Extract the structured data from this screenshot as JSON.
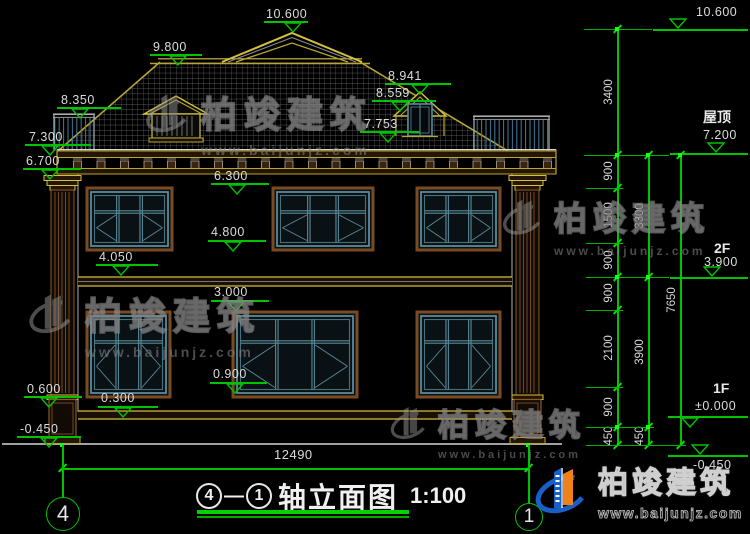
{
  "watermark": {
    "brand": "柏竣建筑",
    "url": "www.baijunjz.com"
  },
  "watermarks": [
    {
      "x": 143,
      "y": 86,
      "scale": 1.0
    },
    {
      "x": 26,
      "y": 286,
      "scale": 1.02
    },
    {
      "x": 500,
      "y": 192,
      "scale": 0.92
    },
    {
      "x": 388,
      "y": 400,
      "scale": 0.85
    }
  ],
  "elevation_markers": [
    {
      "text": "10.600",
      "tx": 266,
      "ty": 8,
      "lx": 264,
      "lw": 44,
      "ly": 21,
      "ax": 293,
      "side": "below"
    },
    {
      "text": "9.800",
      "tx": 153,
      "ty": 41,
      "lx": 150,
      "lw": 52,
      "ly": 54,
      "ax": 178,
      "side": "below"
    },
    {
      "text": "8.350",
      "tx": 61,
      "ty": 94,
      "lx": 57,
      "lw": 64,
      "ly": 107,
      "ax": 80,
      "side": "below"
    },
    {
      "text": "7.300",
      "tx": 29,
      "ty": 131,
      "lx": 25,
      "lw": 66,
      "ly": 144,
      "ax": 50,
      "side": "below"
    },
    {
      "text": "6.700",
      "tx": 26,
      "ty": 155,
      "lx": 23,
      "lw": 58,
      "ly": 168,
      "ax": 50,
      "side": "below"
    },
    {
      "text": "8.941",
      "tx": 388,
      "ty": 70,
      "lx": 385,
      "lw": 66,
      "ly": 83,
      "ax": 420,
      "side": "below"
    },
    {
      "text": "8.559",
      "tx": 376,
      "ty": 87,
      "lx": 372,
      "lw": 64,
      "ly": 100,
      "ax": 400,
      "side": "below"
    },
    {
      "text": "7.753",
      "tx": 364,
      "ty": 118,
      "lx": 360,
      "lw": 60,
      "ly": 131,
      "ax": 388,
      "side": "below"
    },
    {
      "text": "6.300",
      "tx": 214,
      "ty": 170,
      "lx": 211,
      "lw": 58,
      "ly": 183,
      "ax": 237,
      "side": "below"
    },
    {
      "text": "4.800",
      "tx": 211,
      "ty": 226,
      "lx": 208,
      "lw": 58,
      "ly": 240,
      "ax": 233,
      "side": "below"
    },
    {
      "text": "4.050",
      "tx": 99,
      "ty": 251,
      "lx": 96,
      "lw": 62,
      "ly": 264,
      "ax": 121,
      "side": "below"
    },
    {
      "text": "3.000",
      "tx": 214,
      "ty": 286,
      "lx": 211,
      "lw": 58,
      "ly": 300,
      "ax": 236,
      "side": "below"
    },
    {
      "text": "0.900",
      "tx": 213,
      "ty": 368,
      "lx": 210,
      "lw": 57,
      "ly": 382,
      "ax": 235,
      "side": "below"
    },
    {
      "text": "0.300",
      "tx": 101,
      "ty": 392,
      "lx": 98,
      "lw": 60,
      "ly": 406,
      "ax": 123,
      "side": "below"
    },
    {
      "text": "0.600",
      "tx": 27,
      "ty": 383,
      "lx": 24,
      "lw": 58,
      "ly": 396,
      "ax": 49,
      "side": "below"
    },
    {
      "text": "-0.450",
      "tx": 20,
      "ty": 423,
      "lx": 17,
      "lw": 64,
      "ly": 436,
      "ax": 49,
      "side": "below"
    },
    {
      "text": "10.600",
      "tx": 696,
      "ty": 6,
      "lx": 653,
      "lw": 95,
      "ly": 29,
      "ax": 678,
      "side": "above"
    },
    {
      "text": "7.200",
      "name": "屋顶",
      "nx": 703,
      "ny": 110,
      "tx": 703,
      "ty": 129,
      "lx": 670,
      "lw": 78,
      "ly": 153,
      "ax": 716,
      "side": "above"
    },
    {
      "text": "3.900",
      "name": "2F",
      "nx": 714,
      "ny": 241,
      "tx": 704,
      "ty": 256,
      "lx": 670,
      "lw": 78,
      "ly": 277,
      "ax": 712,
      "side": "above"
    },
    {
      "text": "±0.000",
      "name": "1F",
      "nx": 713,
      "ny": 381,
      "tx": 695,
      "ty": 400,
      "lx": 668,
      "lw": 80,
      "ly": 416,
      "ax": 690,
      "side": "below"
    },
    {
      "text": "-0.450",
      "tx": 693,
      "ty": 459,
      "lx": 668,
      "lw": 80,
      "ly": 455,
      "ax": 700,
      "side": "above"
    }
  ],
  "dim_chains": [
    {
      "x": 617,
      "y1": 29,
      "y2": 445,
      "ticks": [
        29,
        155,
        188,
        243,
        277,
        310,
        387,
        427,
        445
      ],
      "labels": [
        {
          "t": "3400",
          "y": 92
        },
        {
          "t": "900",
          "y": 171
        },
        {
          "t": "1500",
          "y": 215
        },
        {
          "t": "900",
          "y": 260
        },
        {
          "t": "900",
          "y": 293
        },
        {
          "t": "2100",
          "y": 348
        },
        {
          "t": "900",
          "y": 407
        },
        {
          "t": "450",
          "y": 436
        }
      ]
    },
    {
      "x": 648,
      "y1": 155,
      "y2": 445,
      "ticks": [
        155,
        277,
        427,
        445
      ],
      "labels": [
        {
          "t": "3300",
          "y": 216
        },
        {
          "t": "3900",
          "y": 352
        },
        {
          "t": "450",
          "y": 436
        }
      ]
    },
    {
      "x": 680,
      "y1": 155,
      "y2": 445,
      "ticks": [
        155,
        445
      ],
      "labels": [
        {
          "t": "7650",
          "y": 300
        }
      ]
    }
  ],
  "ext_lines": [
    {
      "y": 29,
      "x1": 584,
      "x2": 652
    },
    {
      "y": 155,
      "x1": 584,
      "x2": 669
    },
    {
      "y": 188,
      "x1": 586,
      "x2": 623
    },
    {
      "y": 243,
      "x1": 586,
      "x2": 623
    },
    {
      "y": 277,
      "x1": 586,
      "x2": 669
    },
    {
      "y": 310,
      "x1": 586,
      "x2": 623
    },
    {
      "y": 387,
      "x1": 586,
      "x2": 623
    },
    {
      "y": 427,
      "x1": 586,
      "x2": 654
    },
    {
      "y": 445,
      "x1": 586,
      "x2": 686
    }
  ],
  "grips": [
    [
      617,
      29
    ],
    [
      617,
      155
    ],
    [
      648,
      155
    ],
    [
      680,
      155
    ],
    [
      617,
      277
    ],
    [
      648,
      277
    ],
    [
      617,
      427
    ],
    [
      648,
      427
    ],
    [
      62,
      445
    ],
    [
      528,
      445
    ]
  ],
  "bottom_dim": {
    "text": "12490",
    "tx": 274,
    "ty": 448,
    "x1": 62,
    "x2": 528,
    "y": 468
  },
  "axis_lines": [
    {
      "x": 62,
      "y1": 445,
      "y2": 497
    },
    {
      "x": 528,
      "y1": 445,
      "y2": 503
    }
  ],
  "axis_bubbles": [
    {
      "label": "4",
      "cx": 62,
      "cy": 513,
      "r": 16,
      "fs": 22
    },
    {
      "label": "1",
      "cx": 528,
      "cy": 516,
      "r": 13,
      "fs": 19
    }
  ],
  "title": {
    "axis_a": "4",
    "axis_b": "1",
    "dash": "—",
    "name": "轴立面图",
    "scale": "1:100"
  },
  "logo": {
    "brand": "柏竣建筑",
    "url": "www.baijunjz.com"
  }
}
